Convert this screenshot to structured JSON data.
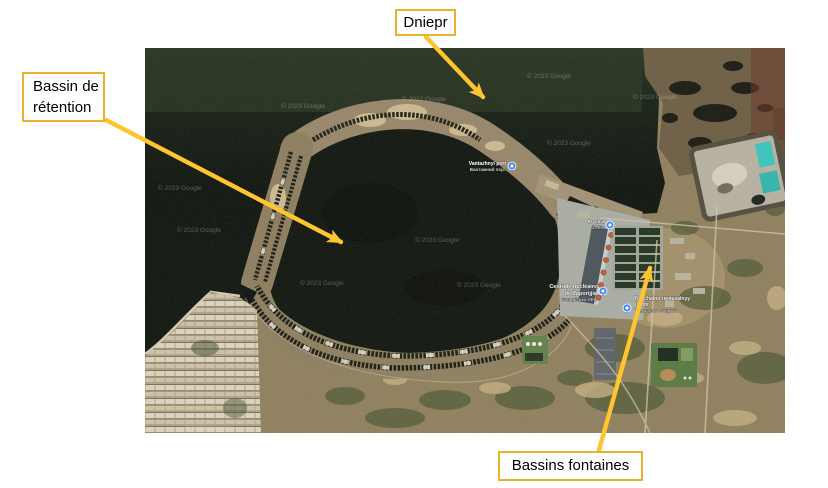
{
  "slide": {
    "background": "#ffffff",
    "callouts": [
      {
        "id": "dniepr",
        "label": "Dniepr"
      },
      {
        "id": "bassin-retention",
        "label": "Bassin de rétention",
        "lines": [
          "Bassin de",
          "rétention"
        ]
      },
      {
        "id": "bassins-fontaines",
        "label": "Bassins fontaines"
      }
    ],
    "callout_style": {
      "border_color": "#ECB02F",
      "fill": "#ffffff",
      "text_color": "#000000",
      "arrow_color": "#FFC52F"
    }
  },
  "map": {
    "provider_watermark": "© 2023 Google",
    "labels": {
      "plant": {
        "lines": [
          "Centrale nucléaire",
          "de Zaporijjia",
          "Запорізька АЕС"
        ]
      },
      "port": {
        "lines": [
          "Vantazhnyi port",
          "Вантажний порт"
        ]
      },
      "berth": {
        "lines": [
          "Prychal",
          "ZAES"
        ]
      },
      "training": {
        "lines": [
          "Navchalno-trenuvalnyy",
          "tsentr",
          "Тимчасово закрито"
        ]
      }
    },
    "icons": {
      "pin": "google-maps-pin"
    },
    "colors": {
      "water_dark": "#0a100b",
      "water_band": "#25301f",
      "land_tan": "#8f7f5e",
      "dam_sand": "#97866a",
      "scrub_green": "#45532f",
      "plant_gray": "#a9aea6",
      "reactor_roof": "#c25b31",
      "spray_cell": "#20301f",
      "ash_pond_cyan": "#37c8c0",
      "marsh_red": "#6a3326"
    }
  }
}
